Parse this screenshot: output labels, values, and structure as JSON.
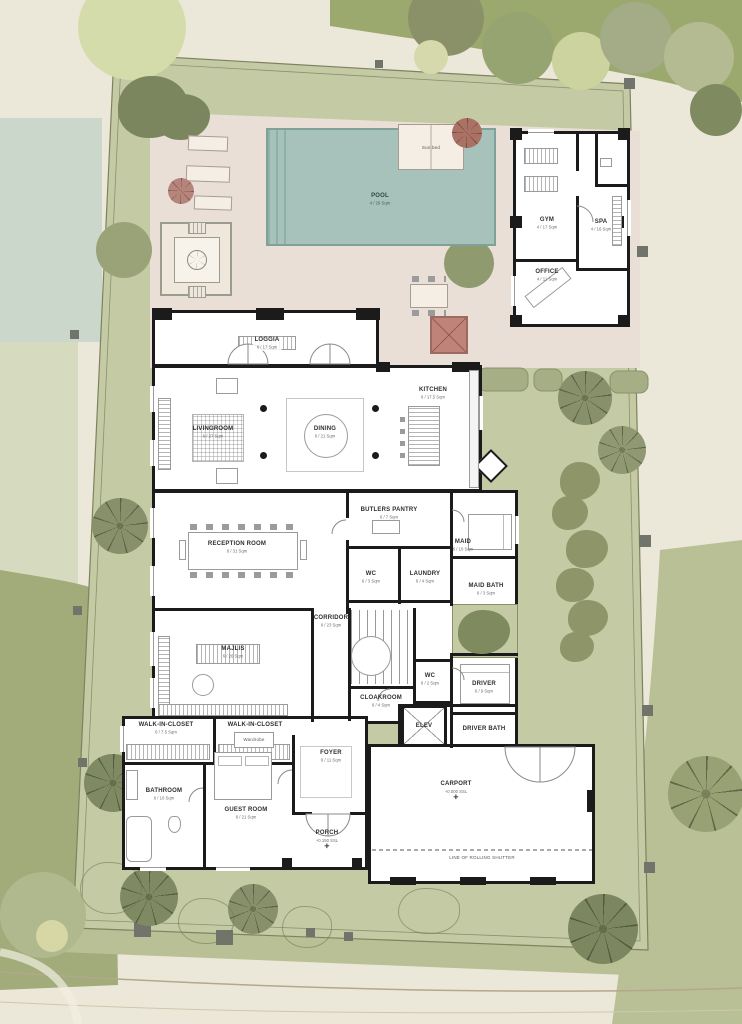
{
  "palette": {
    "paper_beige": "#ece8d9",
    "grass_inner": "#c3caa4",
    "grass_outer_dark": "#9ba96f",
    "grass_outer_mid": "#b9c095",
    "pool_deck": "#e9dfd6",
    "pool_water": "#a7c2ba",
    "wall_black": "#1b1b1b",
    "tree_olive": "#87906a",
    "accent_red": "#c08379",
    "fence_post_gray": "#70746a"
  },
  "rooms": [
    {
      "label": "POOL",
      "size": "4 / 29 Sqm"
    },
    {
      "label": "GYM",
      "size": "4 / 17 Sqm"
    },
    {
      "label": "SPA",
      "size": "4 / 16 Sqm"
    },
    {
      "label": "OFFICE",
      "size": "4 / 11 Sqm"
    },
    {
      "label": "LOGGIA",
      "size": "6 / 17 Sqm"
    },
    {
      "label": "LIVINGROOM",
      "size": "6 / 27 Sqm"
    },
    {
      "label": "DINING",
      "size": "6 / 21 Sqm"
    },
    {
      "label": "KITCHEN",
      "size": "6 / 17.5 Sqm"
    },
    {
      "label": "RECEPTION ROOM",
      "size": "6 / 31 Sqm"
    },
    {
      "label": "BUTLERS PANTRY",
      "size": "6 / 7 Sqm"
    },
    {
      "label": "WC",
      "size": "6 / 3 Sqm"
    },
    {
      "label": "LAUNDRY",
      "size": "6 / 4 Sqm"
    },
    {
      "label": "MAID",
      "size": "6 / 10 Sqm"
    },
    {
      "label": "MAID BATH",
      "size": "6 / 3 Sqm"
    },
    {
      "label": "MAJLIS",
      "size": "6 / 26 Sqm"
    },
    {
      "label": "CORRIDOR",
      "size": "6 / 23 Sqm"
    },
    {
      "label": "CLOAKROOM",
      "size": "6 / 4 Sqm"
    },
    {
      "label": "WC",
      "size": "6 / 2 Sqm"
    },
    {
      "label": "ELEV",
      "size": "6 / 3 Sqm"
    },
    {
      "label": "DRIVER",
      "size": "6 / 9 Sqm"
    },
    {
      "label": "DRIVER BATH",
      "size": "6 / 3 Sqm"
    },
    {
      "label": "WALK-IN-CLOSET",
      "size": "6 / 7.5 Sqm"
    },
    {
      "label": "WALK-IN-CLOSET",
      "size": "6 / 7 Sqm"
    },
    {
      "label": "BATHROOM",
      "size": "6 / 10 Sqm"
    },
    {
      "label": "GUEST ROOM",
      "size": "6 / 21 Sqm"
    },
    {
      "label": "FOYER",
      "size": "6 / 11 Sqm"
    },
    {
      "label": "PORCH",
      "size": "+0.150 SSL"
    },
    {
      "label": "CARPORT",
      "size": "+0.000 SSL"
    }
  ],
  "annotations": {
    "rolling_shutter": "LINE OF ROLLING SHUTTER",
    "wardrobe": "Wardrobe",
    "sun_bed": "Sun bed",
    "survey_marker": "✛"
  }
}
